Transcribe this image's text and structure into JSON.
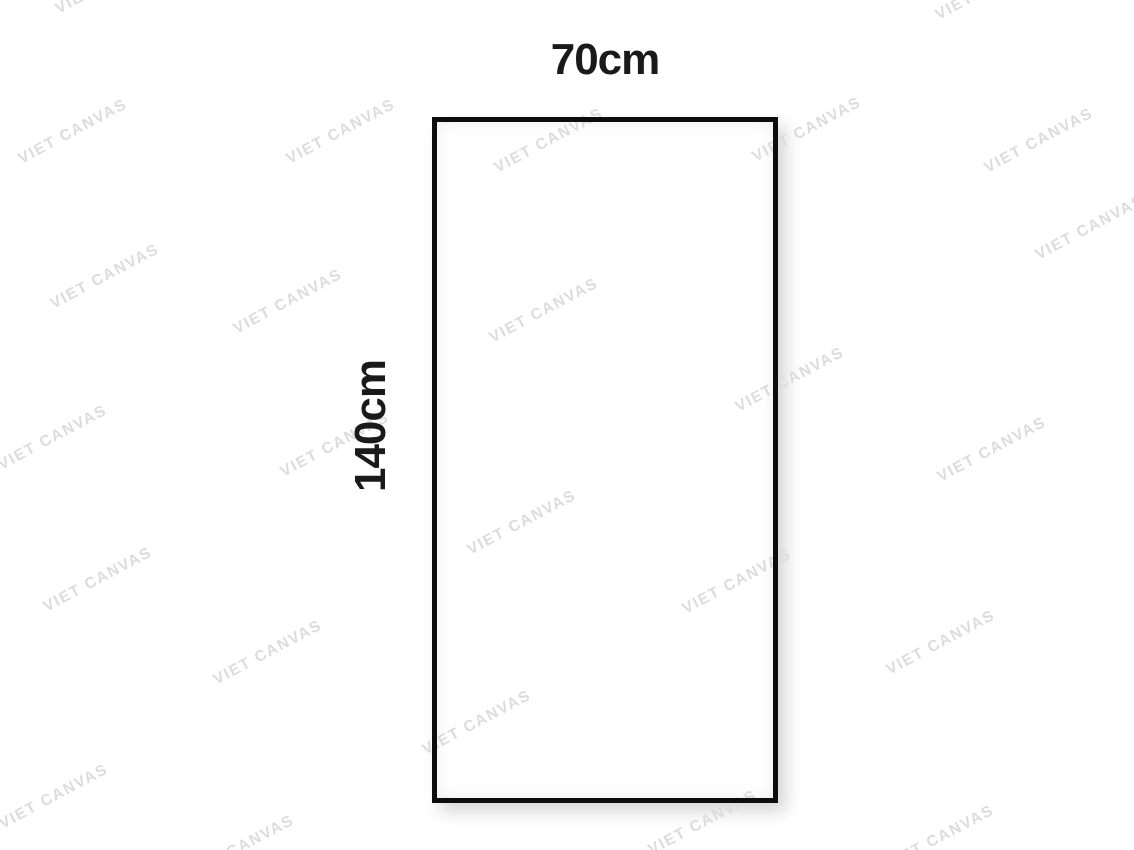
{
  "figure": {
    "width_label": "70cm",
    "height_label": "140cm"
  },
  "watermark": {
    "text": "VIET CANVAS",
    "color": "#dcdcdc",
    "angle_deg": -28,
    "positions": [
      {
        "x": 73,
        "y": 132
      },
      {
        "x": 341,
        "y": 132
      },
      {
        "x": 549,
        "y": 141
      },
      {
        "x": 807,
        "y": 130
      },
      {
        "x": 1039,
        "y": 141
      },
      {
        "x": 110,
        "y": -18
      },
      {
        "x": 990,
        "y": -12
      },
      {
        "x": 1090,
        "y": 228
      },
      {
        "x": 105,
        "y": 277
      },
      {
        "x": 288,
        "y": 302
      },
      {
        "x": 544,
        "y": 311
      },
      {
        "x": 790,
        "y": 380
      },
      {
        "x": 53,
        "y": 438
      },
      {
        "x": 335,
        "y": 445
      },
      {
        "x": 992,
        "y": 450
      },
      {
        "x": 522,
        "y": 523
      },
      {
        "x": 98,
        "y": 580
      },
      {
        "x": 737,
        "y": 582
      },
      {
        "x": 941,
        "y": 643
      },
      {
        "x": 268,
        "y": 653
      },
      {
        "x": 477,
        "y": 723
      },
      {
        "x": 54,
        "y": 797
      },
      {
        "x": 703,
        "y": 823
      },
      {
        "x": 940,
        "y": 838
      },
      {
        "x": 240,
        "y": 848
      }
    ]
  },
  "colors": {
    "background": "#ffffff",
    "border": "#0d0d0d",
    "label_text": "#1a1a1a"
  }
}
